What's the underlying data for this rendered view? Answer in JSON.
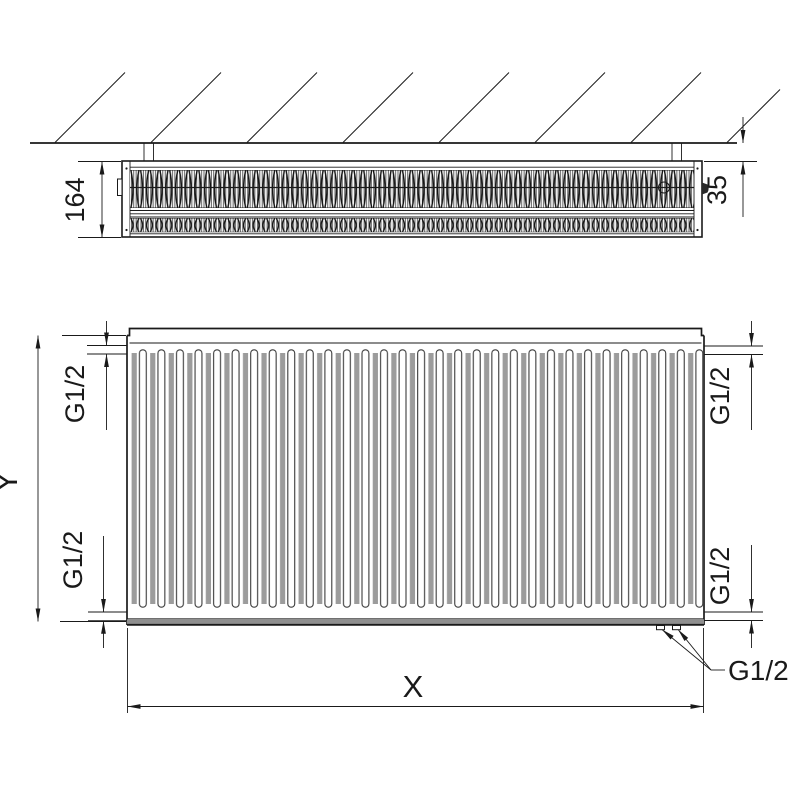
{
  "figure": {
    "title": "radiator-dimension-drawing",
    "top_view": {
      "depth_dim": "164",
      "wall_gap_dim": "35"
    },
    "front_view": {
      "height_dim": "Y",
      "width_dim": "X",
      "conn_top_left": "G1/2",
      "conn_bottom_left": "G1/2",
      "conn_top_right": "G1/2",
      "conn_bottom_right": "G1/2",
      "conn_bottom_center": "G1/2"
    },
    "colors": {
      "line": "#1a1a1a",
      "rib_gray": "#9c9c9c",
      "band_gray": "#8f8f8f",
      "background": "#ffffff"
    }
  }
}
